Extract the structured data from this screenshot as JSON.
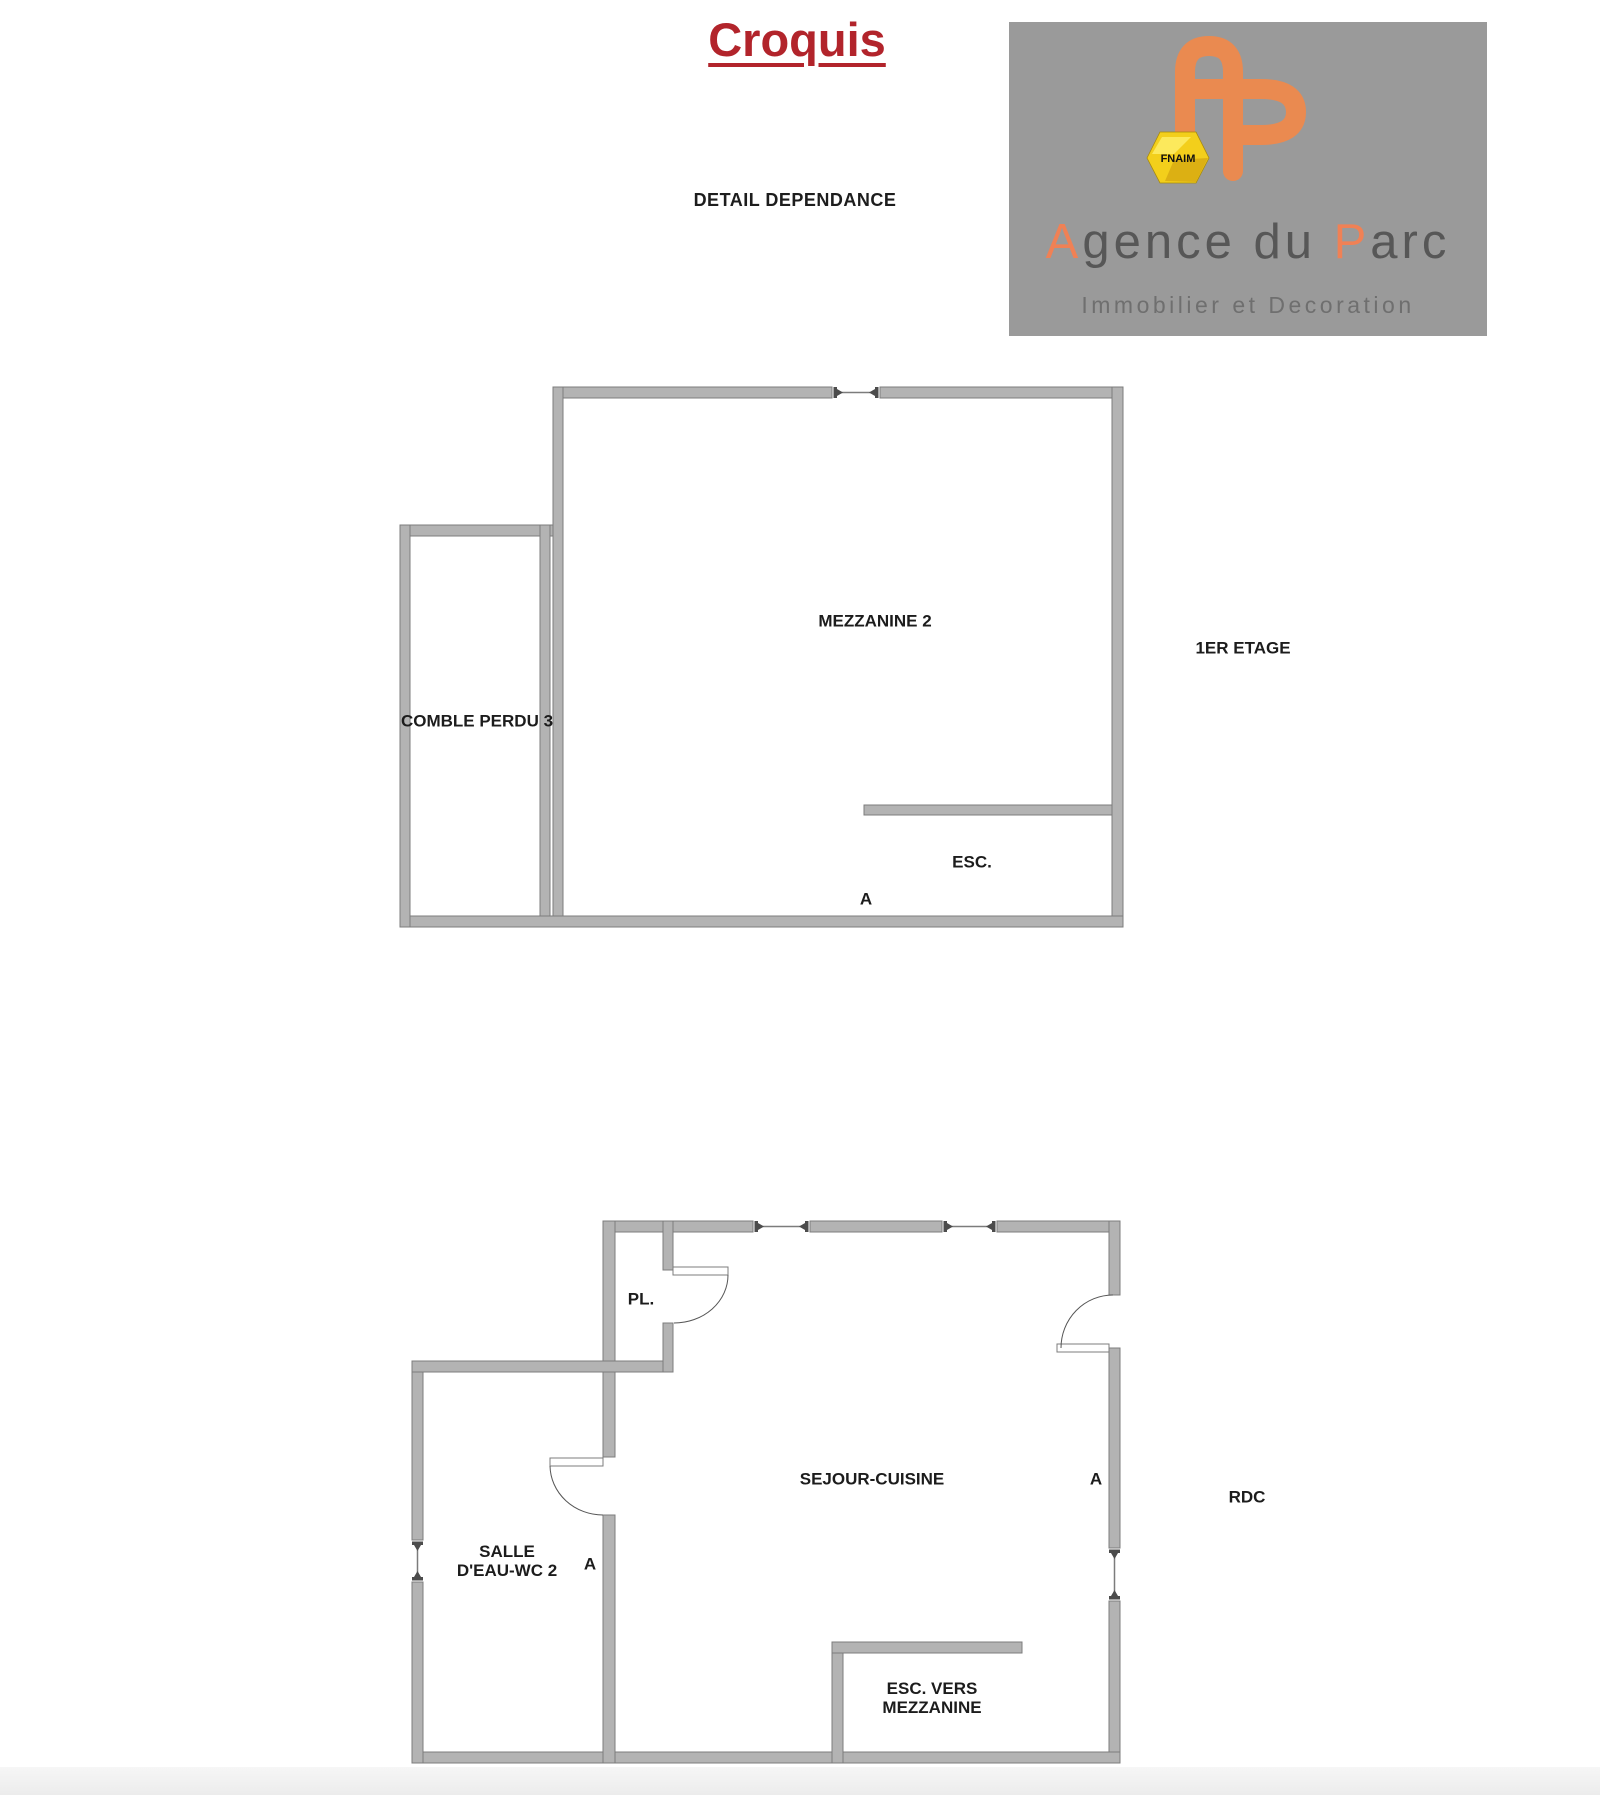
{
  "header": {
    "title": "Croquis",
    "subtitle": "DETAIL DEPENDANCE"
  },
  "logo": {
    "fnaim": "FNAIM",
    "brand_a1": "A",
    "brand_t1": "gence du ",
    "brand_a2": "P",
    "brand_t2": "arc",
    "tagline": "Immobilier et Decoration",
    "colors": {
      "panel": "#9a9a9a",
      "monogram": "#ea8a50",
      "accent": "#f08155",
      "brand_text": "#575757",
      "gem": "#f3cf1b"
    }
  },
  "colors": {
    "wall_fill": "#b3b3b3",
    "wall_edge": "#7c7c7c",
    "marker": "#4c4c4c",
    "label_text": "#1c1c1c",
    "title_red": "#b2242b"
  },
  "plans": [
    {
      "id": "plan-first-floor",
      "name": "1ER ETAGE",
      "name_pos": [
        1243,
        649
      ],
      "walls": [
        [
          553,
          387,
          279,
          11
        ],
        [
          880,
          387,
          243,
          11
        ],
        [
          553,
          387,
          10,
          540
        ],
        [
          1112,
          387,
          11,
          540
        ],
        [
          400,
          916,
          723,
          11
        ],
        [
          400,
          525,
          153,
          11
        ],
        [
          400,
          525,
          10,
          402
        ],
        [
          540,
          525,
          10,
          391
        ]
      ],
      "ledges": [
        [
          864,
          805,
          248,
          10
        ]
      ],
      "windows": [
        {
          "line": [
            841,
            392.5,
            871,
            392.5
          ],
          "markers": [
            {
              "x": 832,
              "y": 387,
              "dir": "right"
            },
            {
              "x": 880,
              "y": 387,
              "dir": "left"
            }
          ]
        }
      ],
      "doors": [],
      "labels": [
        {
          "text": "MEZZANINE 2",
          "x": 875,
          "y": 622
        },
        {
          "text": "COMBLE PERDU 3",
          "x": 477,
          "y": 722
        },
        {
          "text": "ESC.",
          "x": 972,
          "y": 863
        },
        {
          "text": "A",
          "x": 866,
          "y": 900
        }
      ]
    },
    {
      "id": "plan-ground-floor",
      "name": "RDC",
      "name_pos": [
        1247,
        1498
      ],
      "walls": [
        [
          603,
          1221,
          150,
          11
        ],
        [
          810,
          1221,
          132,
          11
        ],
        [
          997,
          1221,
          123,
          11
        ],
        [
          1109,
          1221,
          11,
          74
        ],
        [
          1109,
          1348,
          11,
          200
        ],
        [
          1109,
          1601,
          11,
          162
        ],
        [
          412,
          1752,
          708,
          11
        ],
        [
          412,
          1361,
          11,
          179
        ],
        [
          412,
          1582,
          11,
          181
        ],
        [
          412,
          1361,
          261,
          11
        ],
        [
          603,
          1221,
          12,
          140
        ],
        [
          603,
          1372,
          12,
          85
        ],
        [
          603,
          1515,
          12,
          248
        ],
        [
          663,
          1221,
          10,
          49
        ],
        [
          663,
          1323,
          10,
          49
        ],
        [
          832,
          1642,
          11,
          121
        ],
        [
          832,
          1642,
          190,
          11
        ]
      ],
      "ledges": [],
      "windows": [
        {
          "line": [
            761,
            1226.5,
            802,
            1226.5
          ],
          "markers": [
            {
              "x": 753,
              "y": 1221,
              "dir": "right"
            },
            {
              "x": 810,
              "y": 1221,
              "dir": "left"
            }
          ]
        },
        {
          "line": [
            950,
            1226.5,
            989,
            1226.5
          ],
          "markers": [
            {
              "x": 942,
              "y": 1221,
              "dir": "right"
            },
            {
              "x": 997,
              "y": 1221,
              "dir": "left"
            }
          ]
        },
        {
          "line": [
            1114.5,
            1556,
            1114.5,
            1593
          ],
          "markers": [
            {
              "x": 1109,
              "y": 1548,
              "dir": "down"
            },
            {
              "x": 1109,
              "y": 1601,
              "dir": "up"
            }
          ]
        },
        {
          "line": [
            417.5,
            1548,
            417.5,
            1574
          ],
          "markers": [
            {
              "x": 412,
              "y": 1540,
              "dir": "down"
            },
            {
              "x": 412,
              "y": 1582,
              "dir": "up"
            }
          ]
        }
      ],
      "doors": [
        {
          "leaf": [
            673,
            1267,
            55,
            8
          ],
          "arc": "M 728 1275 A 54 48 0 0 1 674 1323"
        },
        {
          "leaf": [
            1057,
            1344,
            52,
            8
          ],
          "arc": "M 1113 1295 A 52 53 0 0 0 1061 1348"
        },
        {
          "leaf": [
            550,
            1458,
            53,
            8
          ],
          "arc": "M 550 1466 A 53 50 0 0 0 603 1515"
        }
      ],
      "labels": [
        {
          "text": "PL.",
          "x": 641,
          "y": 1300
        },
        {
          "text": "SEJOUR-CUISINE",
          "x": 872,
          "y": 1480
        },
        {
          "text": "A",
          "x": 1096,
          "y": 1480
        },
        {
          "lines": [
            "SALLE",
            "D'EAU-WC 2"
          ],
          "x": 507,
          "y": 1553
        },
        {
          "text": "A",
          "x": 590,
          "y": 1565
        },
        {
          "lines": [
            "ESC. VERS",
            "MEZZANINE"
          ],
          "x": 932,
          "y": 1690
        }
      ]
    }
  ]
}
